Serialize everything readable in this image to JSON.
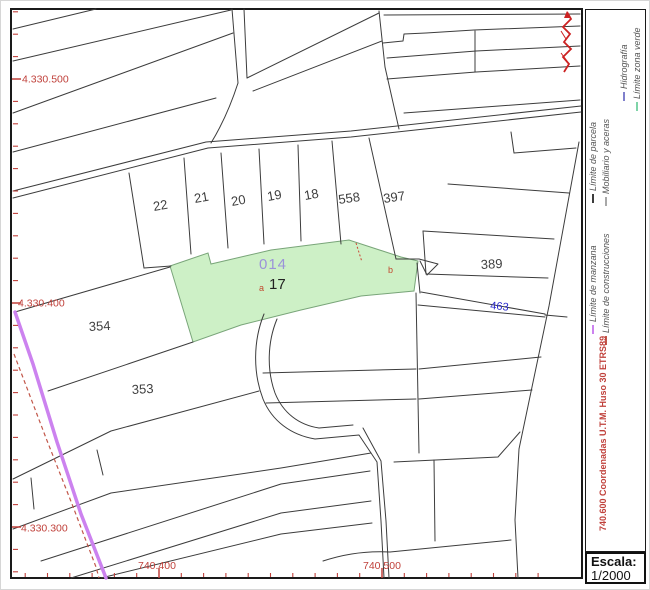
{
  "map": {
    "parcels": [
      "22",
      "21",
      "20",
      "19",
      "18",
      "558",
      "397",
      "389",
      "354",
      "353"
    ],
    "highlight": {
      "manzana_code": "014",
      "parcel_number": "17",
      "sub_a": "a",
      "sub_b": "b"
    },
    "road_label": "463",
    "coordinate_labels": {
      "y": [
        "4.330.500",
        "4.330.400",
        "4.330.300"
      ],
      "x": [
        "740.400",
        "740.500"
      ]
    }
  },
  "legend": {
    "items": [
      {
        "label": "Límite de parcela",
        "color": "#3c3c3c"
      },
      {
        "label": "Mobiliario y aceras",
        "color": "#a8a8a8"
      },
      {
        "label": "Límite de manzana",
        "color": "#cc82ef"
      },
      {
        "label": "Límite de construcciones",
        "color": "#c2574a"
      },
      {
        "label": "Hidrografía",
        "color": "#8080cc"
      },
      {
        "label": "Límite zona verde",
        "color": "#7fd4a8"
      }
    ],
    "crs_note": "740.600 Coordenadas U.T.M. Huso 30 ETRS89"
  },
  "scale": {
    "label": "Escala:",
    "value": "1/2000"
  },
  "colors": {
    "parcel_highlight_fill": "#cdf0c6",
    "manzana_line": "#cc82ef",
    "construction_line": "#c2574a",
    "coordinate_red": "#c0413b",
    "annotation_red": "#cc2222",
    "manzana_label_purple": "#9b93d9",
    "road_label_blue": "#2b2bcc",
    "parcel_line": "#3c3c3c"
  }
}
